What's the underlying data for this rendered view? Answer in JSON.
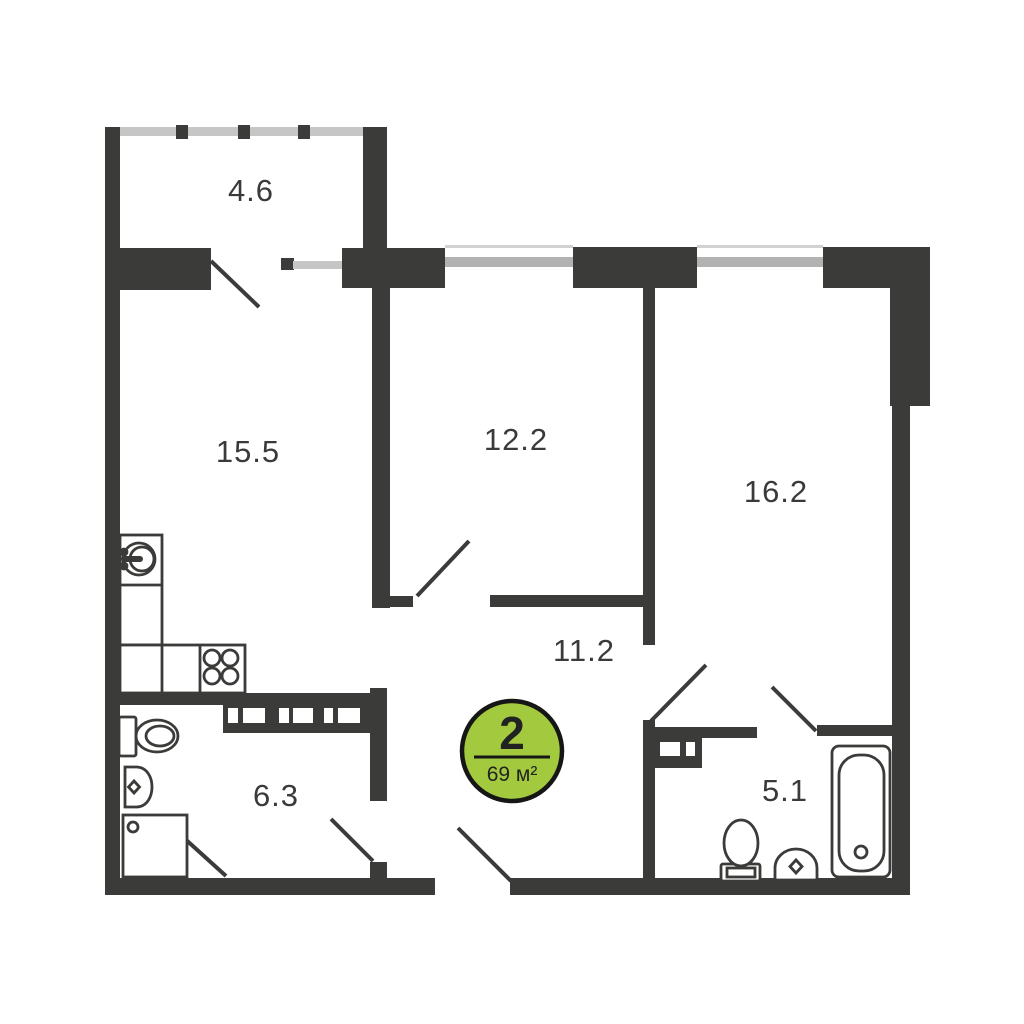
{
  "plan": {
    "type": "apartment-floor-plan",
    "badge": {
      "rooms_count": "2",
      "total_area": "69 м²"
    },
    "rooms": [
      {
        "name": "balcony",
        "area": "4.6",
        "fixtures": []
      },
      {
        "name": "kitchen-living",
        "area": "15.5",
        "fixtures": [
          "sink-icon",
          "stove-icon",
          "counter"
        ]
      },
      {
        "name": "bedroom",
        "area": "12.2",
        "fixtures": []
      },
      {
        "name": "living-room",
        "area": "16.2",
        "fixtures": []
      },
      {
        "name": "hallway",
        "area": "11.2",
        "fixtures": []
      },
      {
        "name": "bathroom",
        "area": "6.3",
        "fixtures": [
          "toilet-icon",
          "washbasin-icon",
          "shower-icon",
          "vent-shaft"
        ]
      },
      {
        "name": "bathroom-2",
        "area": "5.1",
        "fixtures": [
          "toilet-icon",
          "washbasin-icon",
          "bathtub-icon",
          "vent-shaft"
        ]
      }
    ],
    "colors": {
      "wall": "#3b3b39",
      "badge_green": "#a3ca3e",
      "badge_outline": "#161616",
      "window_glass": "#b2b2b2",
      "window_frame": "#d2d2d2",
      "glazing": "#c6c6c6",
      "label_text": "#3a3a3a"
    }
  }
}
